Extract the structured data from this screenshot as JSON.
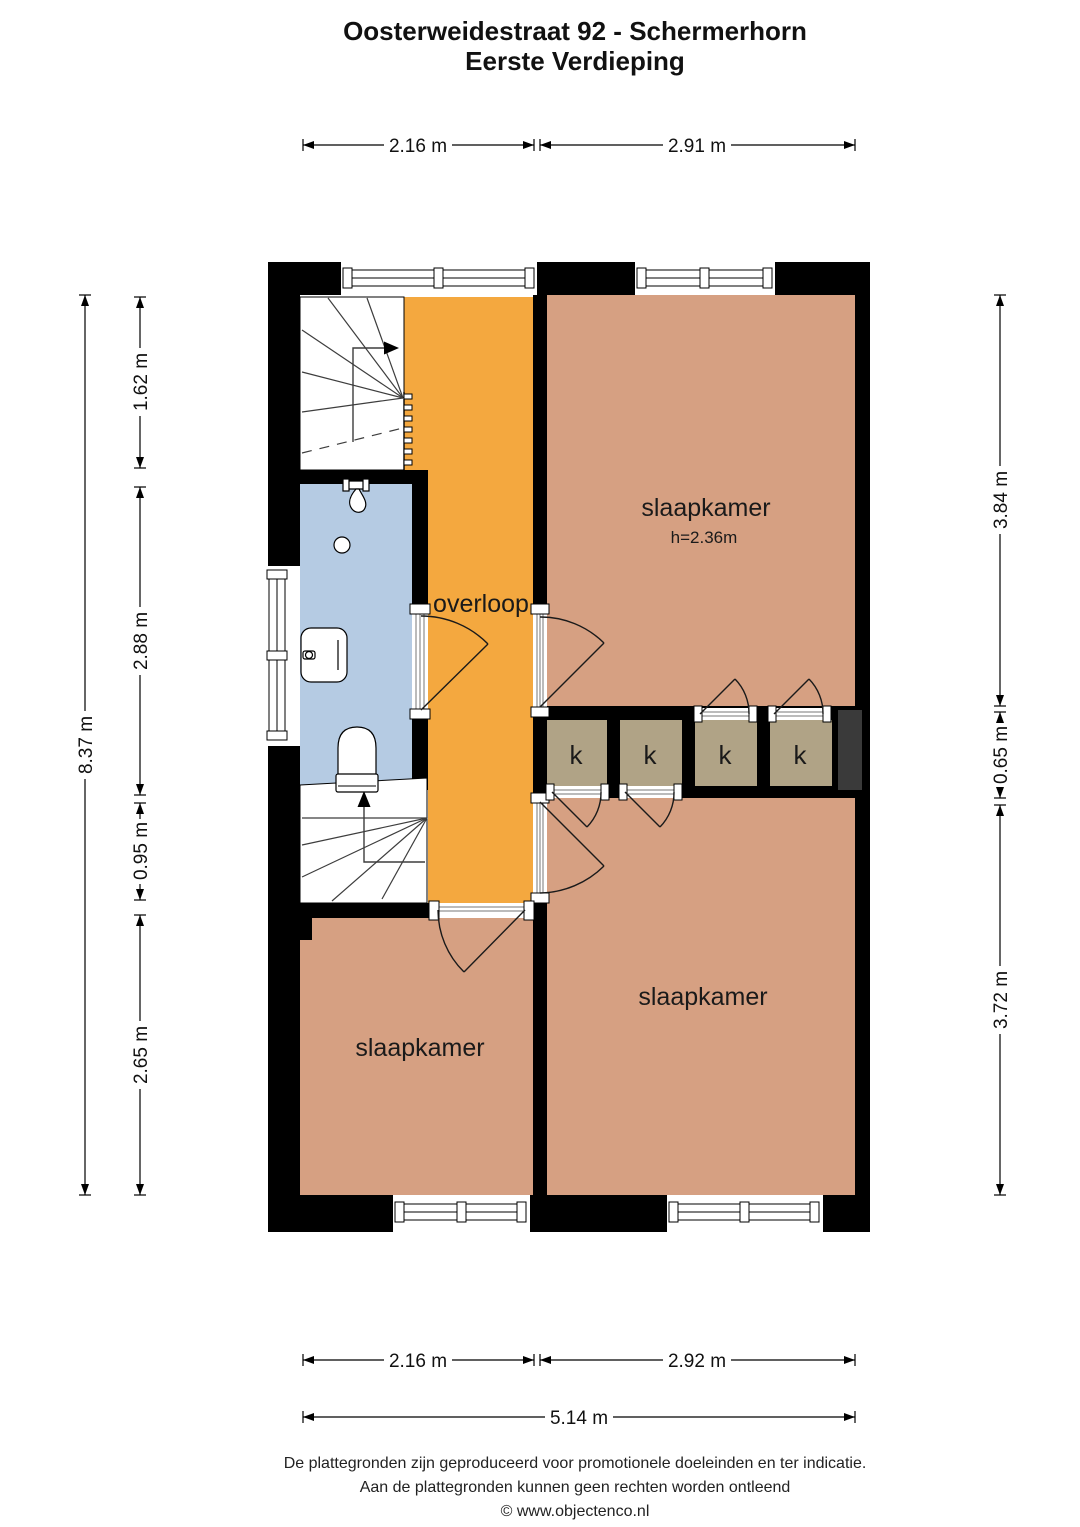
{
  "title": {
    "line1": "Oosterweidestraat 92 - Schermerhorn",
    "line2": "Eerste Verdieping"
  },
  "rooms": {
    "bedroom_top": {
      "label": "slaapkamer",
      "ceiling_height": "h=2.36m"
    },
    "bedroom_bottom_right": {
      "label": "slaapkamer"
    },
    "bedroom_bottom_left": {
      "label": "slaapkamer"
    },
    "landing": {
      "label": "overloop"
    },
    "closets": {
      "labels": [
        "k",
        "k",
        "k",
        "k"
      ]
    }
  },
  "dimensions": {
    "top": [
      "2.16 m",
      "2.91 m"
    ],
    "left_total": "8.37 m",
    "left": [
      "1.62 m",
      "2.88 m",
      "0.95 m",
      "2.65 m"
    ],
    "right": [
      "3.84 m",
      "0.65 m",
      "3.72 m"
    ],
    "bottom": [
      "2.16 m",
      "2.92 m"
    ],
    "bottom_total": "5.14 m"
  },
  "footer": {
    "line1": "De plattegronden zijn geproduceerd voor promotionele doeleinden en ter indicatie.",
    "line2": "Aan de plattegronden kunnen geen rechten worden ontleend",
    "line3": "© www.objectenco.nl"
  },
  "colors": {
    "floor_bedroom": "#D6A082",
    "floor_landing": "#F4A83F",
    "floor_bathroom": "#B5CBE3",
    "floor_closet": "#B0A386",
    "wall": "#000000",
    "shaft": "#3A3A3A"
  }
}
